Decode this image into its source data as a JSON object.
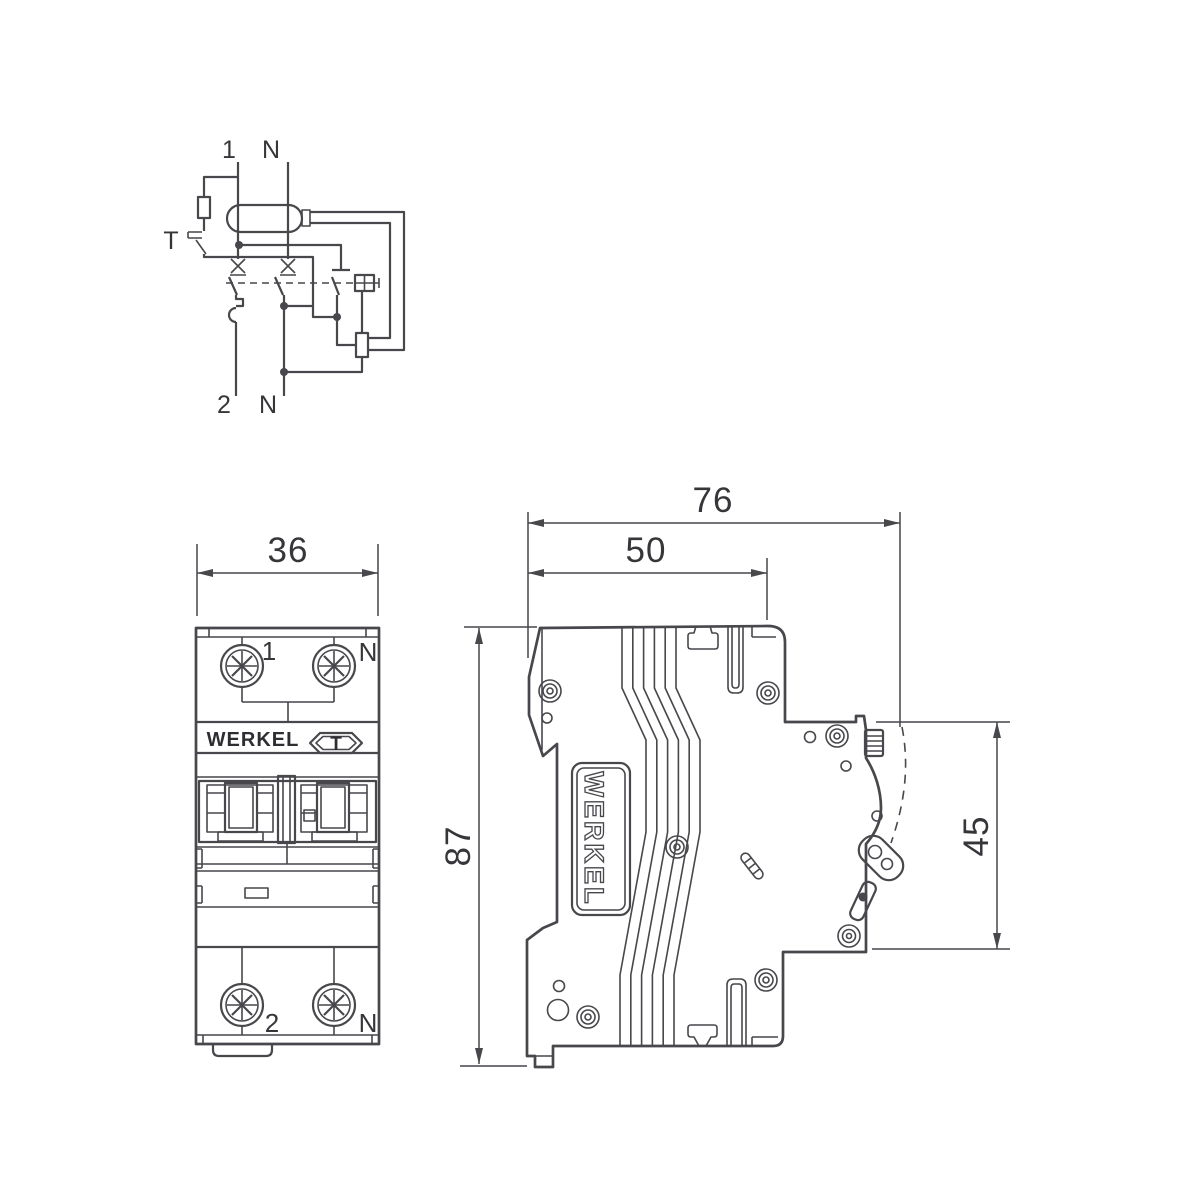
{
  "title": "Werkel RCBO dimensional technical drawing",
  "colors": {
    "line": "#47474c",
    "text": "#36363a",
    "background": "#ffffff"
  },
  "wiring_diagram": {
    "terminal_top_line": "1",
    "terminal_top_neutral": "N",
    "test_button_label": "T",
    "terminal_bottom_line": "2",
    "terminal_bottom_neutral": "N"
  },
  "front_view": {
    "width_dimension": "36",
    "top_terminal_line": "1",
    "top_terminal_neutral": "N",
    "brand": "WERKEL",
    "test_button_label": "T",
    "bottom_terminal_line": "2",
    "bottom_terminal_neutral": "N"
  },
  "side_view": {
    "overall_depth_dimension": "76",
    "body_depth_dimension": "50",
    "height_dimension": "87",
    "rear_height_dimension": "45",
    "brand": "WERKEL"
  }
}
